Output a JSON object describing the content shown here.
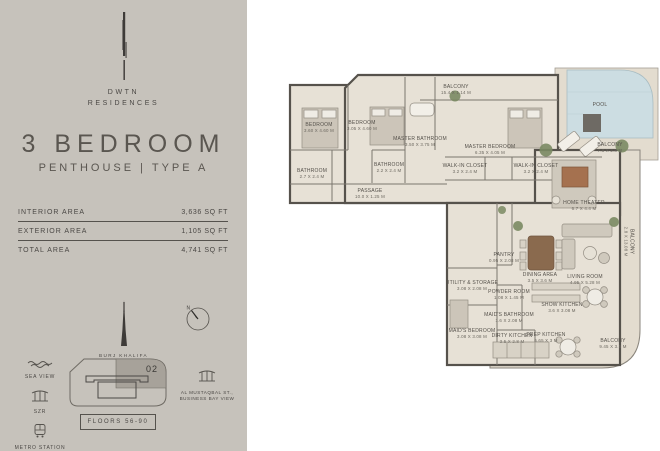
{
  "sidebar": {
    "brand": {
      "line1": "DWTN",
      "line2": "RESIDENCES"
    },
    "title": "3 BEDROOM",
    "subtitle": "PENTHOUSE | TYPE A",
    "areas": [
      {
        "label": "INTERIOR AREA",
        "value": "3,636 SQ FT"
      },
      {
        "label": "EXTERIOR AREA",
        "value": "1,105 SQ FT"
      },
      {
        "label": "TOTAL AREA",
        "value": "4,741 SQ FT"
      }
    ],
    "landmark": "BURJ KHALIFA",
    "compass_n": "N",
    "views": {
      "sea": "SEA VIEW",
      "szr": "SZR",
      "metro": "METRO STATION",
      "street": "AL MUSTAQBAL ST., BUSINESS BAY VIEW"
    },
    "unit_number": "02",
    "floors": "FLOORS 56-90"
  },
  "plan": {
    "rooms": [
      {
        "label": "BEDROOM",
        "dims": "3.60 X 4.60 M"
      },
      {
        "label": "BATHROOM",
        "dims": "2.7 X 2.4 M"
      },
      {
        "label": "BEDROOM",
        "dims": "3.05 X 4.60 M"
      },
      {
        "label": "BATHROOM",
        "dims": "2.2 X 2.4 M"
      },
      {
        "label": "MASTER BATHROOM",
        "dims": "3.50 X 3.75 M"
      },
      {
        "label": "PASSAGE",
        "dims": "10.0 X 1.25 M"
      },
      {
        "label": "BALCONY",
        "dims": "15.4 X 1.14 M"
      },
      {
        "label": "MASTER BEDROOM",
        "dims": "6.35 X 4.05 M"
      },
      {
        "label": "WALK-IN CLOSET",
        "dims": "3.2 X 2.4 M"
      },
      {
        "label": "WALK-IN CLOSET",
        "dims": "3.2 X 2.4 M"
      },
      {
        "label": "POOL",
        "dims": ""
      },
      {
        "label": "BALCONY",
        "dims": "7.8 X 2.8 M"
      },
      {
        "label": "HOME THEATER",
        "dims": "6.7 X 4.4 M"
      },
      {
        "label": "BALCONY",
        "dims": "2.8 X 13.08 M"
      },
      {
        "label": "PANTRY",
        "dims": "0.95 X 2.08 M"
      },
      {
        "label": "DINING AREA",
        "dims": "3.5 X 3.6 M"
      },
      {
        "label": "LIVING ROOM",
        "dims": "4.95 X 5.28 M"
      },
      {
        "label": "UTILITY & STORAGE",
        "dims": "3.08 X 2.08 M"
      },
      {
        "label": "POWDER ROOM",
        "dims": "1.08 X 1.45 M"
      },
      {
        "label": "MAID'S BATHROOM",
        "dims": "1.6 X 2.08 M"
      },
      {
        "label": "MAID'S BEDROOM",
        "dims": "3.08 X 3.08 M"
      },
      {
        "label": "DIRTY KITCHEN",
        "dims": "3.5 X 2.8 M"
      },
      {
        "label": "SHOW KITCHEN",
        "dims": "3.6 X 3.08 M"
      },
      {
        "label": "PREP KITCHEN",
        "dims": "6.65 X 3 M"
      },
      {
        "label": "BALCONY",
        "dims": "9.45 X 3.5 M"
      }
    ]
  },
  "colors": {
    "sidebar_bg": "#c6c2bb",
    "text_dark": "#4b4845",
    "floor": "#e7e1d6",
    "balcony_floor": "#e3dccf",
    "wall": "#56524c",
    "pool": "#ccdde2",
    "unit_highlight": "#a7a29a",
    "plant_green": "#7a8a63",
    "wood": "#8a6a4e"
  }
}
